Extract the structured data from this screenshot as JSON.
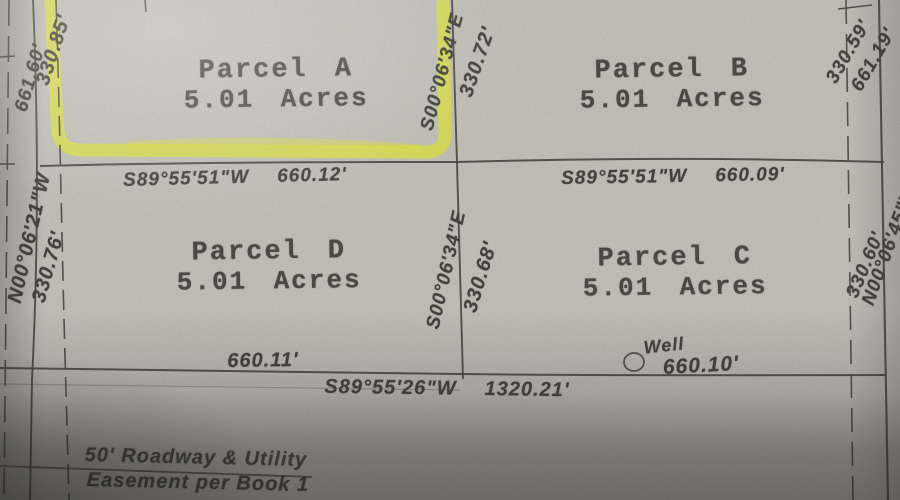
{
  "parcels": [
    {
      "name": "Parcel A",
      "area": "5.01 Acres"
    },
    {
      "name": "Parcel B",
      "area": "5.01 Acres"
    },
    {
      "name": "Parcel D",
      "area": "5.01 Acres"
    },
    {
      "name": "Parcel C",
      "area": "5.01 Acres"
    }
  ],
  "boundaries": {
    "west_outer_bearing": "N00°06'21\"W",
    "west_outer_distance": "661.60'",
    "west_upper": "330.85'",
    "west_lower": "330.76'",
    "center_upper_bearing": "S00°06'34\"E",
    "center_upper_distance": "330.72'",
    "center_lower_bearing": "S00°06'34\"E",
    "center_lower_distance": "330.68'",
    "east_outer_bearing": "N00°06'45\"W",
    "east_outer_distance": "661.19'",
    "east_upper": "330.59'",
    "east_lower": "330.60'",
    "mid_left_bearing": "S89°55'51\"W",
    "mid_left_distance": "660.12'",
    "mid_right_bearing": "S89°55'51\"W",
    "mid_right_distance": "660.09'",
    "south_bearing": "S89°55'26\"W",
    "south_distance": "1320.21'",
    "south_left_distance": "660.11'",
    "south_right_distance": "660.10'"
  },
  "well": {
    "label": "Well"
  },
  "notes": {
    "easement_line1": "50' Roadway & Utility",
    "easement_line2": "Easement per Book 1"
  },
  "colors": {
    "paper": "#c1bfb6",
    "ink": "#45443e",
    "highlight": "#dade47"
  }
}
